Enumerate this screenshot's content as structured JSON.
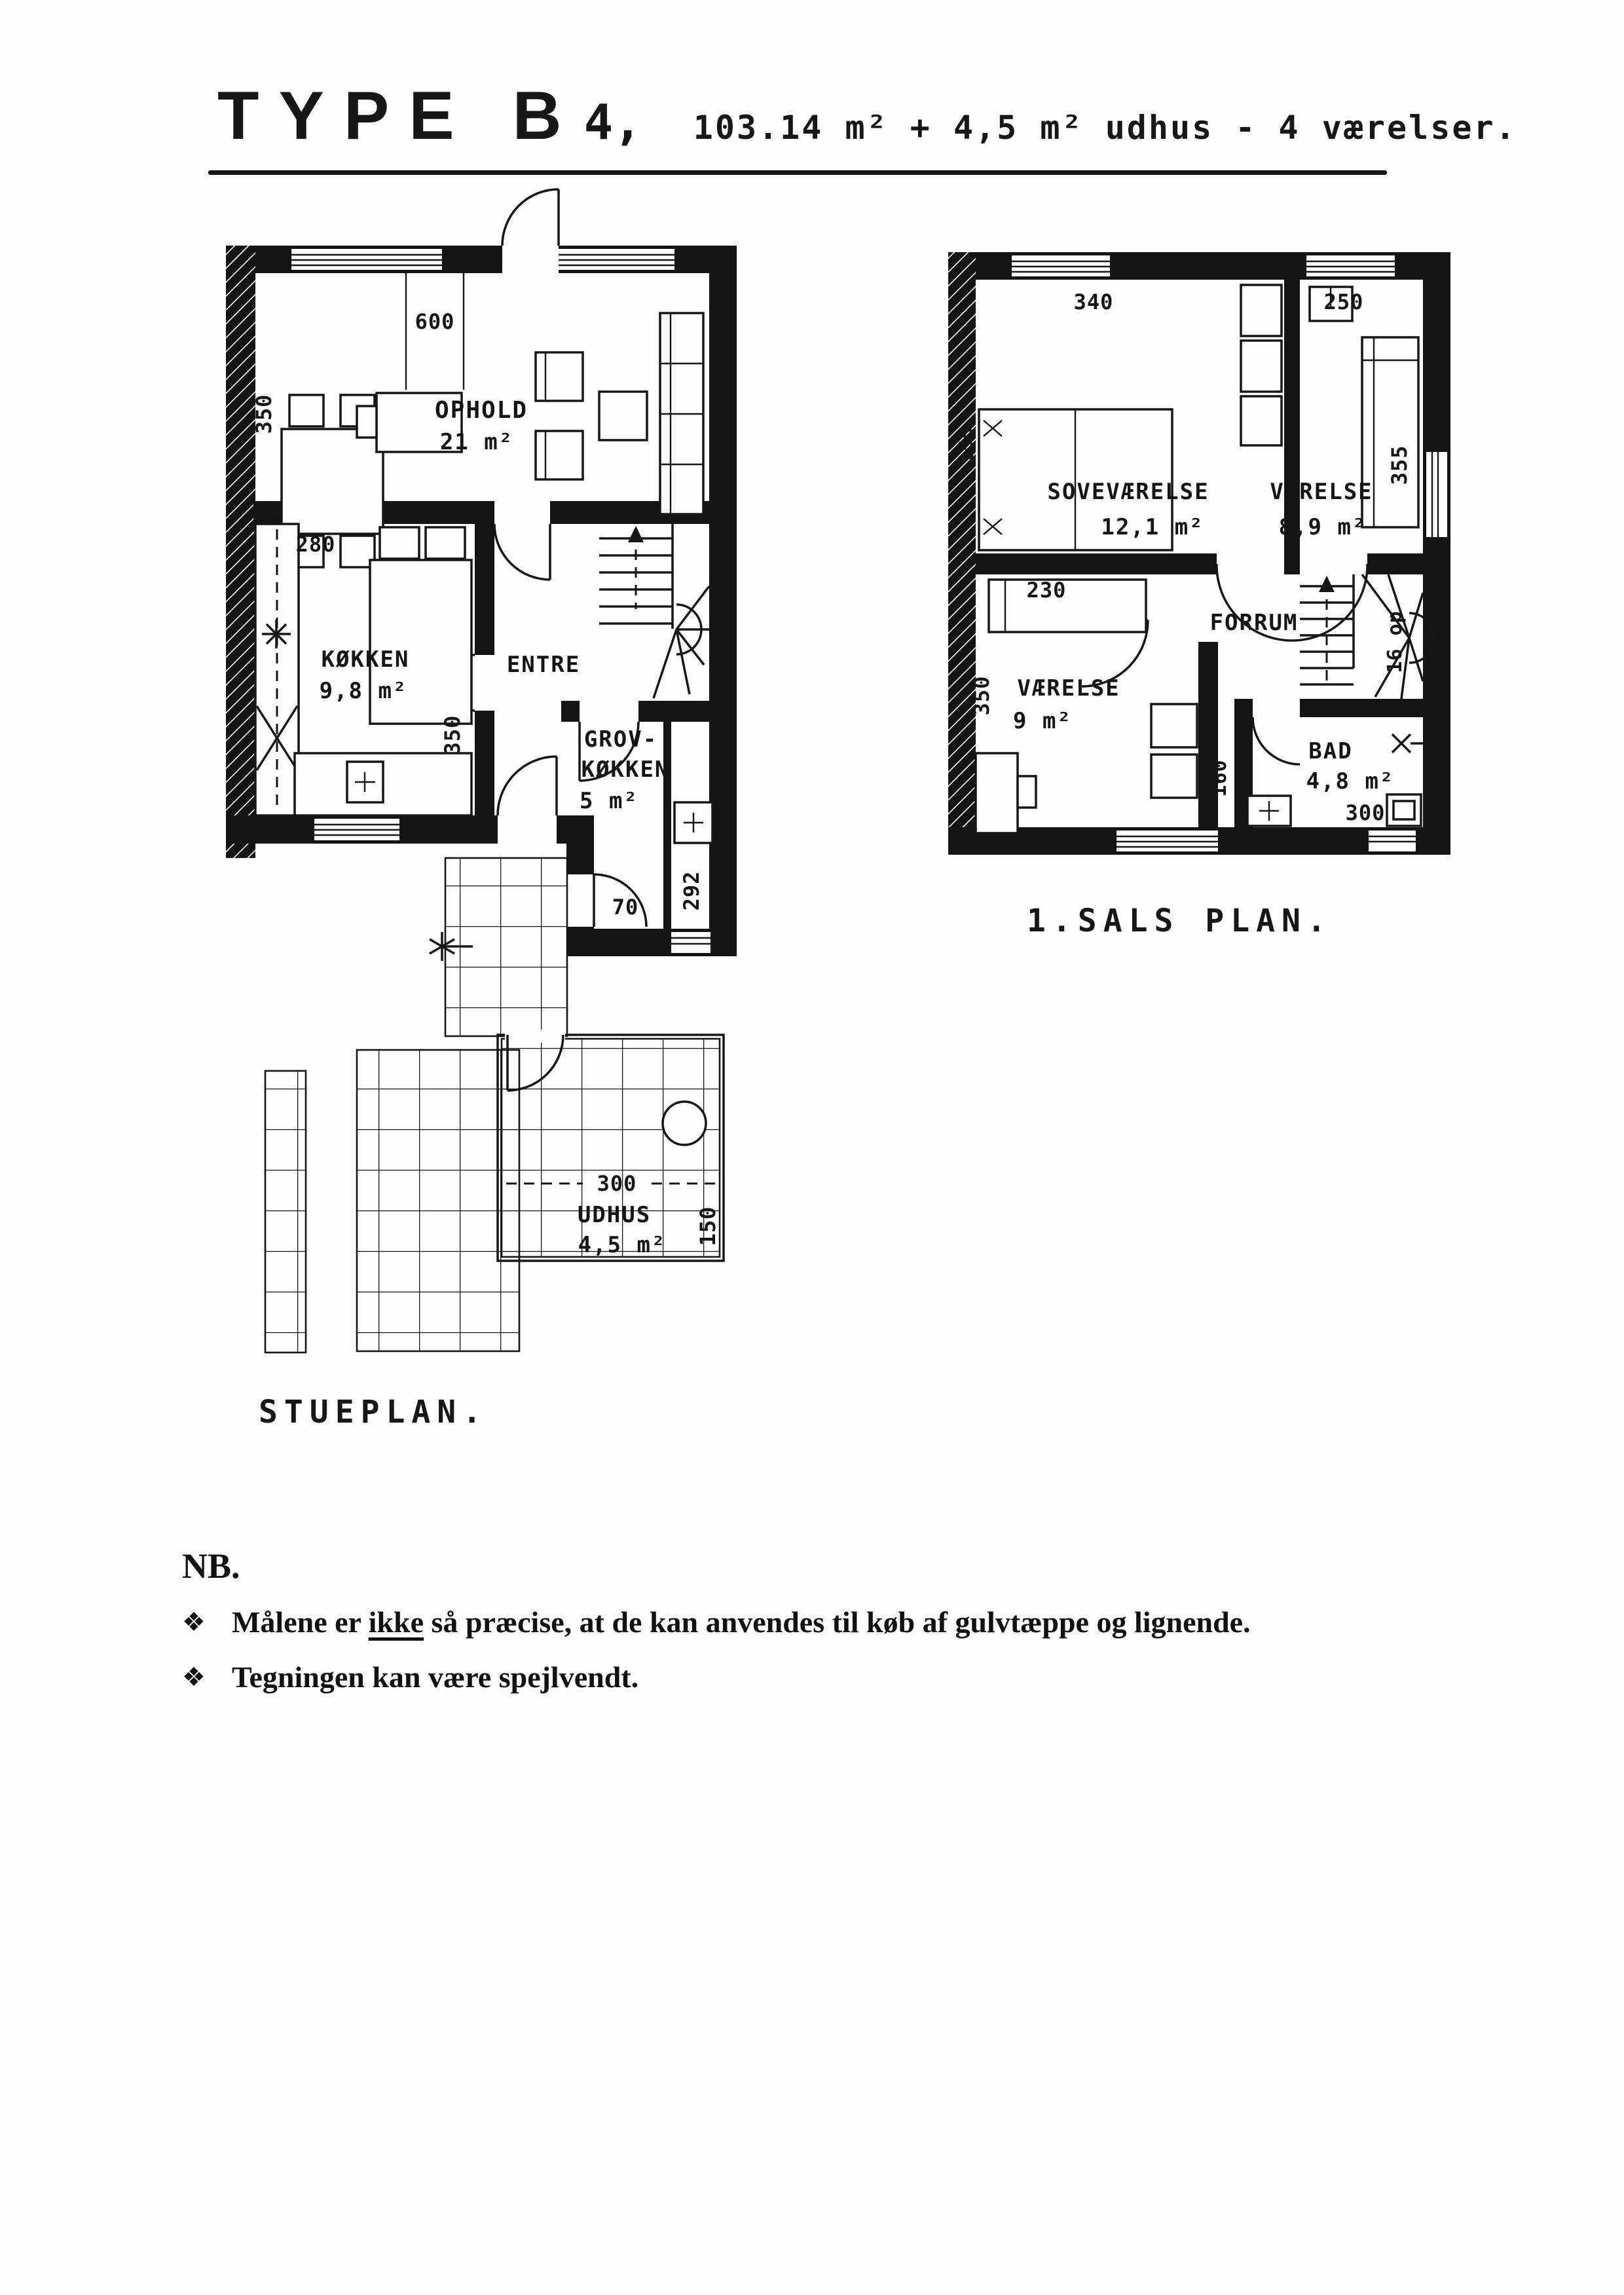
{
  "title": {
    "main": "TYPE B",
    "variant": "4,",
    "subtitle": "103.14 m² + 4,5 m² udhus - 4 værelser."
  },
  "stueplan": {
    "label": "STUEPLAN.",
    "rooms": {
      "ophold": {
        "name": "OPHOLD",
        "area": "21 m²"
      },
      "kokken": {
        "name": "KØKKEN",
        "area": "9,8 m²"
      },
      "entre": {
        "name": "ENTRE"
      },
      "grovkokken": {
        "name_line1": "GROV-",
        "name_line2": "KØKKEN",
        "area": "5 m²"
      },
      "udhus": {
        "name": "UDHUS",
        "area": "4,5 m²"
      }
    },
    "dims": {
      "top_width": "600",
      "left_height": "350",
      "kokken_width": "280",
      "kokken_door": "350",
      "grov_depth": "292",
      "grov_door": "70",
      "udhus_width": "300",
      "udhus_depth": "150"
    }
  },
  "first_floor": {
    "label": "1.SALS PLAN.",
    "rooms": {
      "sovevaerelse": {
        "name": "SOVEVÆRELSE",
        "area": "12,1 m²"
      },
      "vaerelse_ne": {
        "name": "VÆRELSE",
        "area": "8,9 m²"
      },
      "vaerelse_sw": {
        "name": "VÆRELSE",
        "area": "9 m²"
      },
      "forrum": {
        "name": "FORRUM"
      },
      "bad": {
        "name": "BAD",
        "area": "4,8 m²"
      }
    },
    "dims": {
      "sove_width": "340",
      "vaerelse_width": "250",
      "vaerelse_depth": "355",
      "bed_width": "155",
      "bed_length": "230",
      "room_height": "350",
      "hall_width": "160",
      "bad_width": "300",
      "stairs": "16 op"
    }
  },
  "notes": {
    "heading": "NB.",
    "bullet": "❖",
    "items": [
      {
        "pre": "Målene er ",
        "underlined": "ikke",
        "post": " så præcise, at de kan anvendes til køb af gulvtæppe og lignende."
      },
      {
        "pre": "",
        "underlined": "",
        "post": "Tegningen kan være spejlvendt."
      }
    ]
  },
  "colors": {
    "ink": "#141414",
    "paper": "#fdfdfb"
  }
}
